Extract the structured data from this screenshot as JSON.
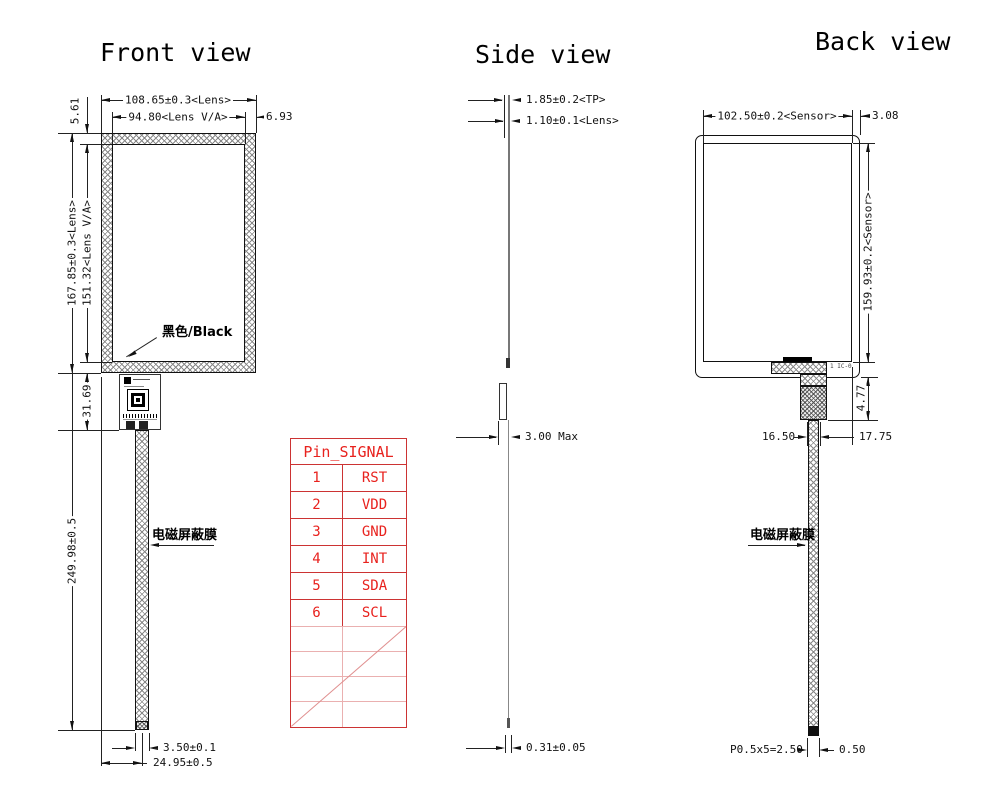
{
  "front_view": {
    "title": "Front view",
    "labels": {
      "frame_color": "黑色/Black",
      "shield_film": "电磁屏蔽膜"
    },
    "dims": {
      "lens_width": "108.65±0.3<Lens>",
      "va_width": "94.80<Lens V/A>",
      "va_right_gap": "6.93",
      "va_top_gap": "5.61",
      "lens_height": "167.85±0.3<Lens>",
      "va_height": "151.32<Lens V/A>",
      "connector_zone_height": "31.69",
      "tail_length": "249.98±0.5",
      "tail_width": "3.50±0.1",
      "tail_offset": "24.95±0.5"
    }
  },
  "side_view": {
    "title": "Side view",
    "dims": {
      "tp_thickness": "1.85±0.2<TP>",
      "lens_thickness": "1.10±0.1<Lens>",
      "max_thickness": "3.00 Max",
      "film_thickness": "0.31±0.05"
    }
  },
  "back_view": {
    "title": "Back view",
    "labels": {
      "shield_film": "电磁屏蔽膜",
      "connector_note": "1 IC-0"
    },
    "dims": {
      "sensor_width": "102.50±0.2<Sensor>",
      "sensor_right_gap": "3.08",
      "sensor_height": "159.93±0.2<Sensor>",
      "stiffener_height": "4.77",
      "tail_offset_left": "16.50",
      "tail_offset_right": "17.75",
      "pad_pitch": "P0.5x5=2.50",
      "tail_end_width": "0.50"
    }
  },
  "pin_table": {
    "header": "Pin_SIGNAL",
    "rows": [
      {
        "pin": "1",
        "signal": "RST"
      },
      {
        "pin": "2",
        "signal": "VDD"
      },
      {
        "pin": "3",
        "signal": "GND"
      },
      {
        "pin": "4",
        "signal": "INT"
      },
      {
        "pin": "5",
        "signal": "SDA"
      },
      {
        "pin": "6",
        "signal": "SCL"
      }
    ]
  },
  "colors": {
    "line": "#1a1a1a",
    "table_red": "#e8221e",
    "table_grid_red": "#cc3333",
    "table_grid_light": "#eab0b0",
    "background": "#ffffff"
  }
}
